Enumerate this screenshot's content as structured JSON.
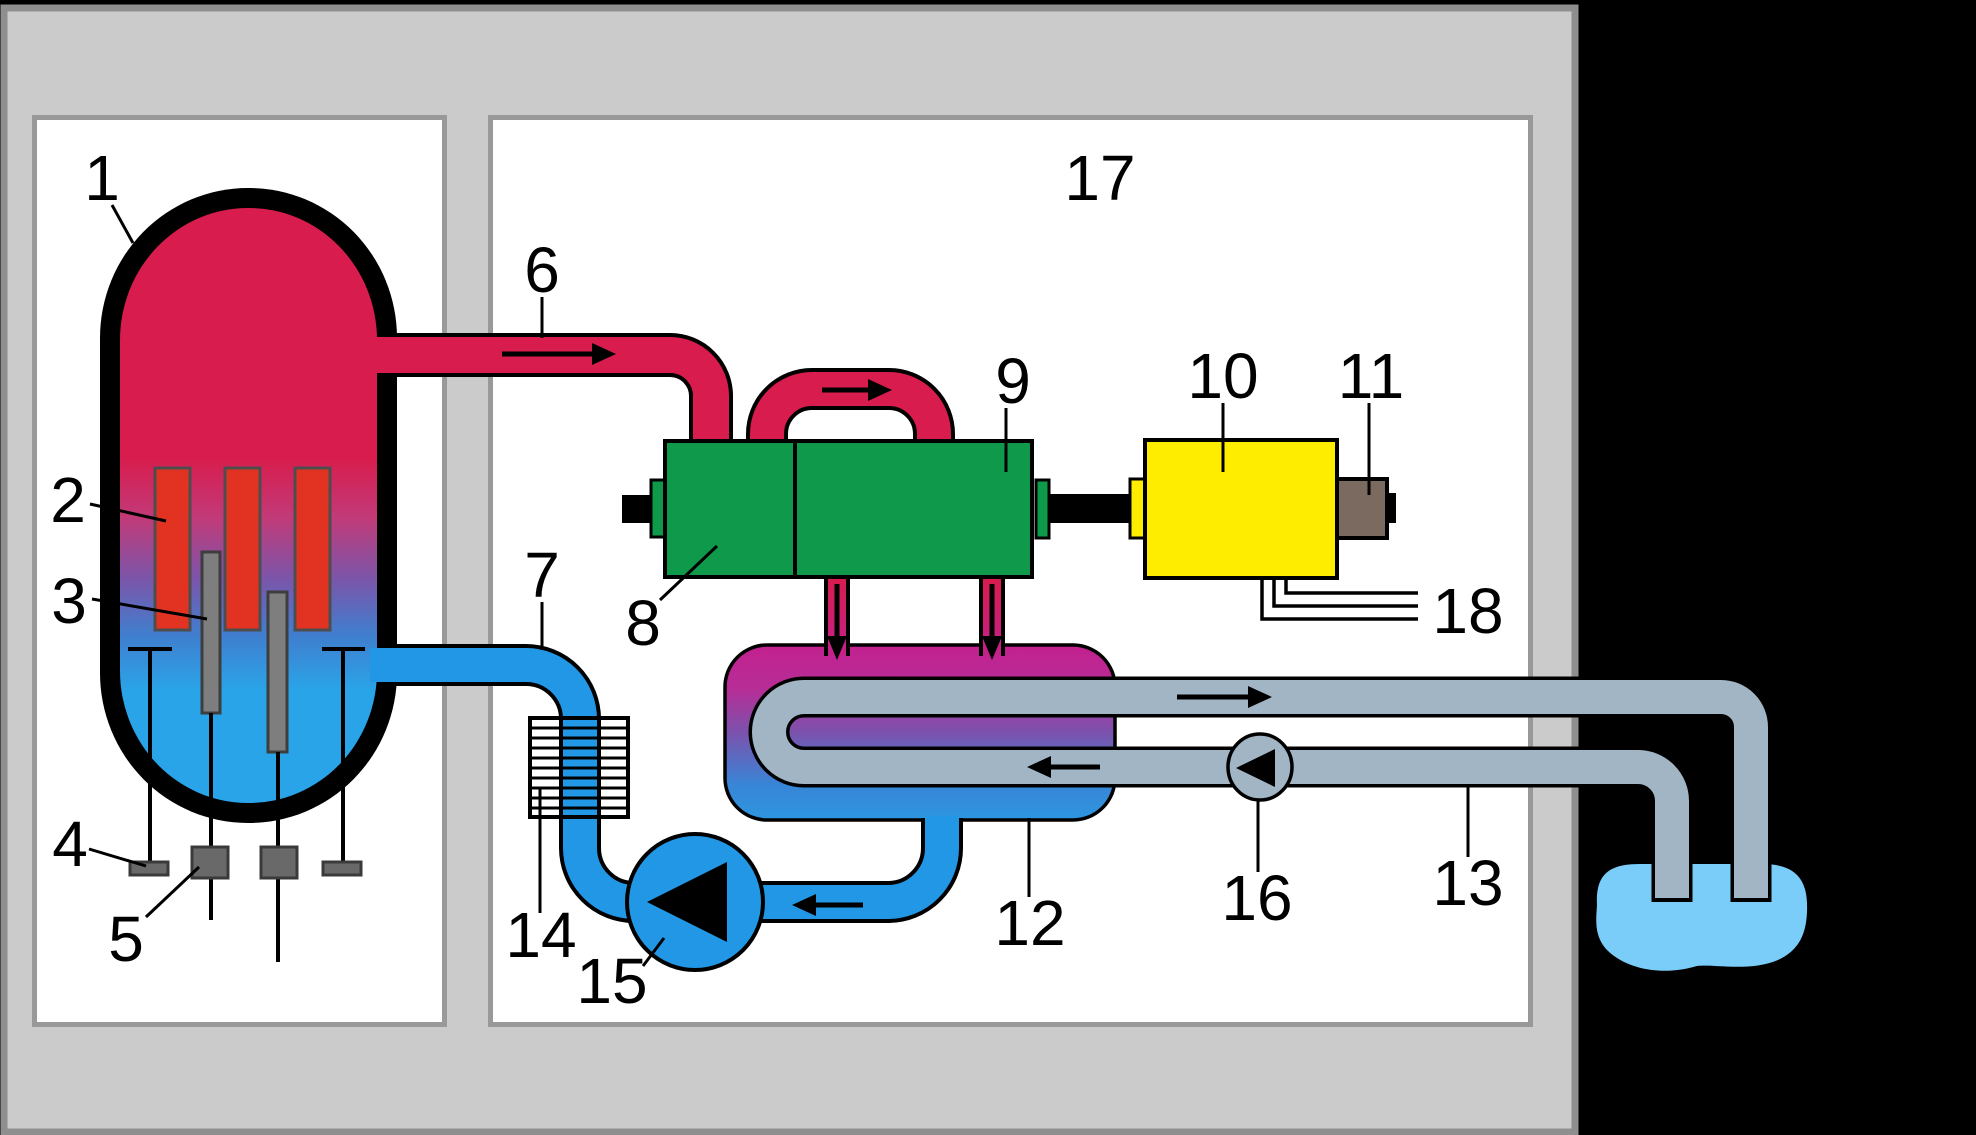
{
  "labels": [
    "1",
    "2",
    "3",
    "4",
    "5",
    "6",
    "7",
    "8",
    "9",
    "10",
    "11",
    "12",
    "13",
    "14",
    "15",
    "16",
    "17",
    "18"
  ],
  "colors": {
    "background": "#000000",
    "containment_fill": "#cbcbcb",
    "containment_border": "#8f8f8f",
    "panel_fill": "#ffffff",
    "panel_border": "#999999",
    "steam_crimson": "#d81c4d",
    "fuel_rod_red": "#e23222",
    "rod_gray": "#7e7e7e",
    "drive_gray": "#696969",
    "vessel_purple": "#7d54a8",
    "vessel_blue": "#2aa4e8",
    "turbine_green": "#0e9a4a",
    "generator_yellow": "#ffed00",
    "exciter_taupe": "#7a6a60",
    "condenser_magenta": "#c2218f",
    "condenser_purple": "#7b52ad",
    "condenser_blue": "#2d96e0",
    "water_blue": "#2197e5",
    "cooling_gray": "#a1b5c5",
    "source_water": "#7acdf8",
    "line_black": "#000000"
  }
}
